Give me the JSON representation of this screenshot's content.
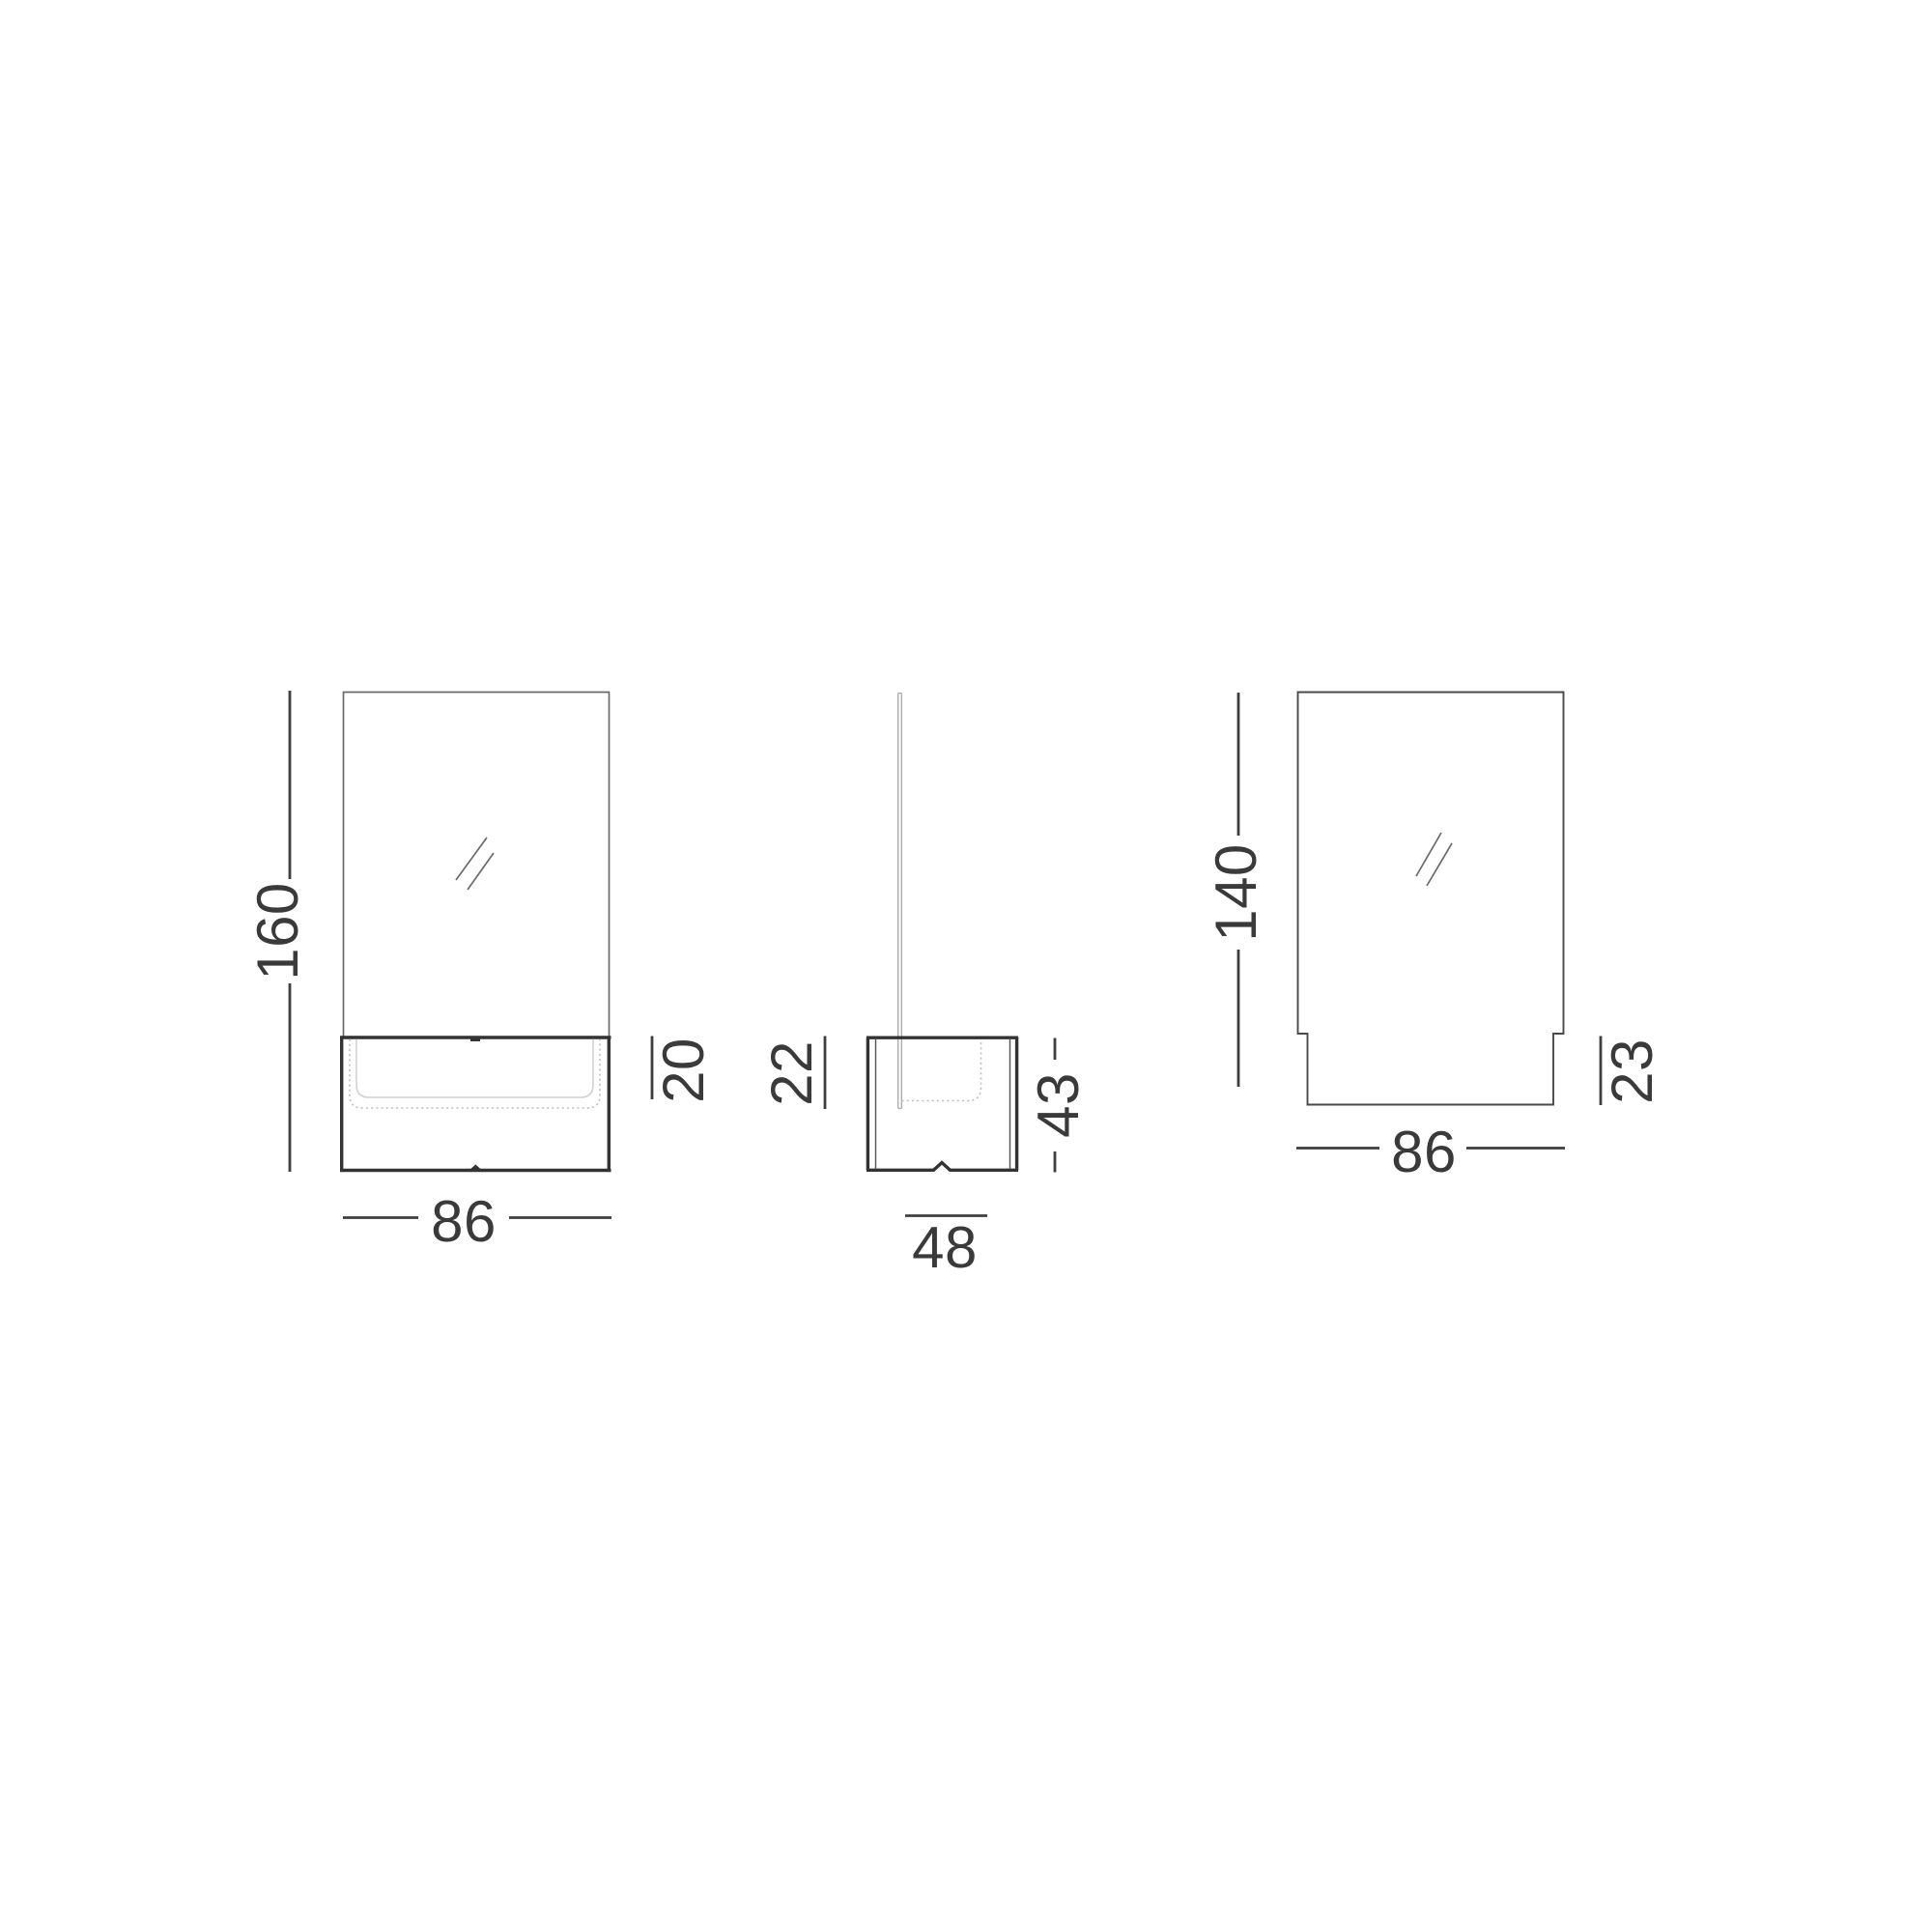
{
  "colors": {
    "background": "#ffffff",
    "line_dark": "#333333",
    "line_dim": "#3e3e3e",
    "line_medium": "#4a4a4a",
    "line_thin": "#5a5a5a",
    "line_glass": "#6a6a6a",
    "line_mirror_edge": "#a8a8a8",
    "line_hidden": "#bdbdbd",
    "line_inset": "#d2d2d2",
    "text": "#3a3a3a"
  },
  "views": {
    "front": {
      "height": "160",
      "opening_height": "20",
      "width": "86"
    },
    "side": {
      "depth_top": "22",
      "base_height": "43",
      "base_depth": "48"
    },
    "mirror": {
      "height": "140",
      "overlap_height": "23",
      "width": "86"
    }
  }
}
